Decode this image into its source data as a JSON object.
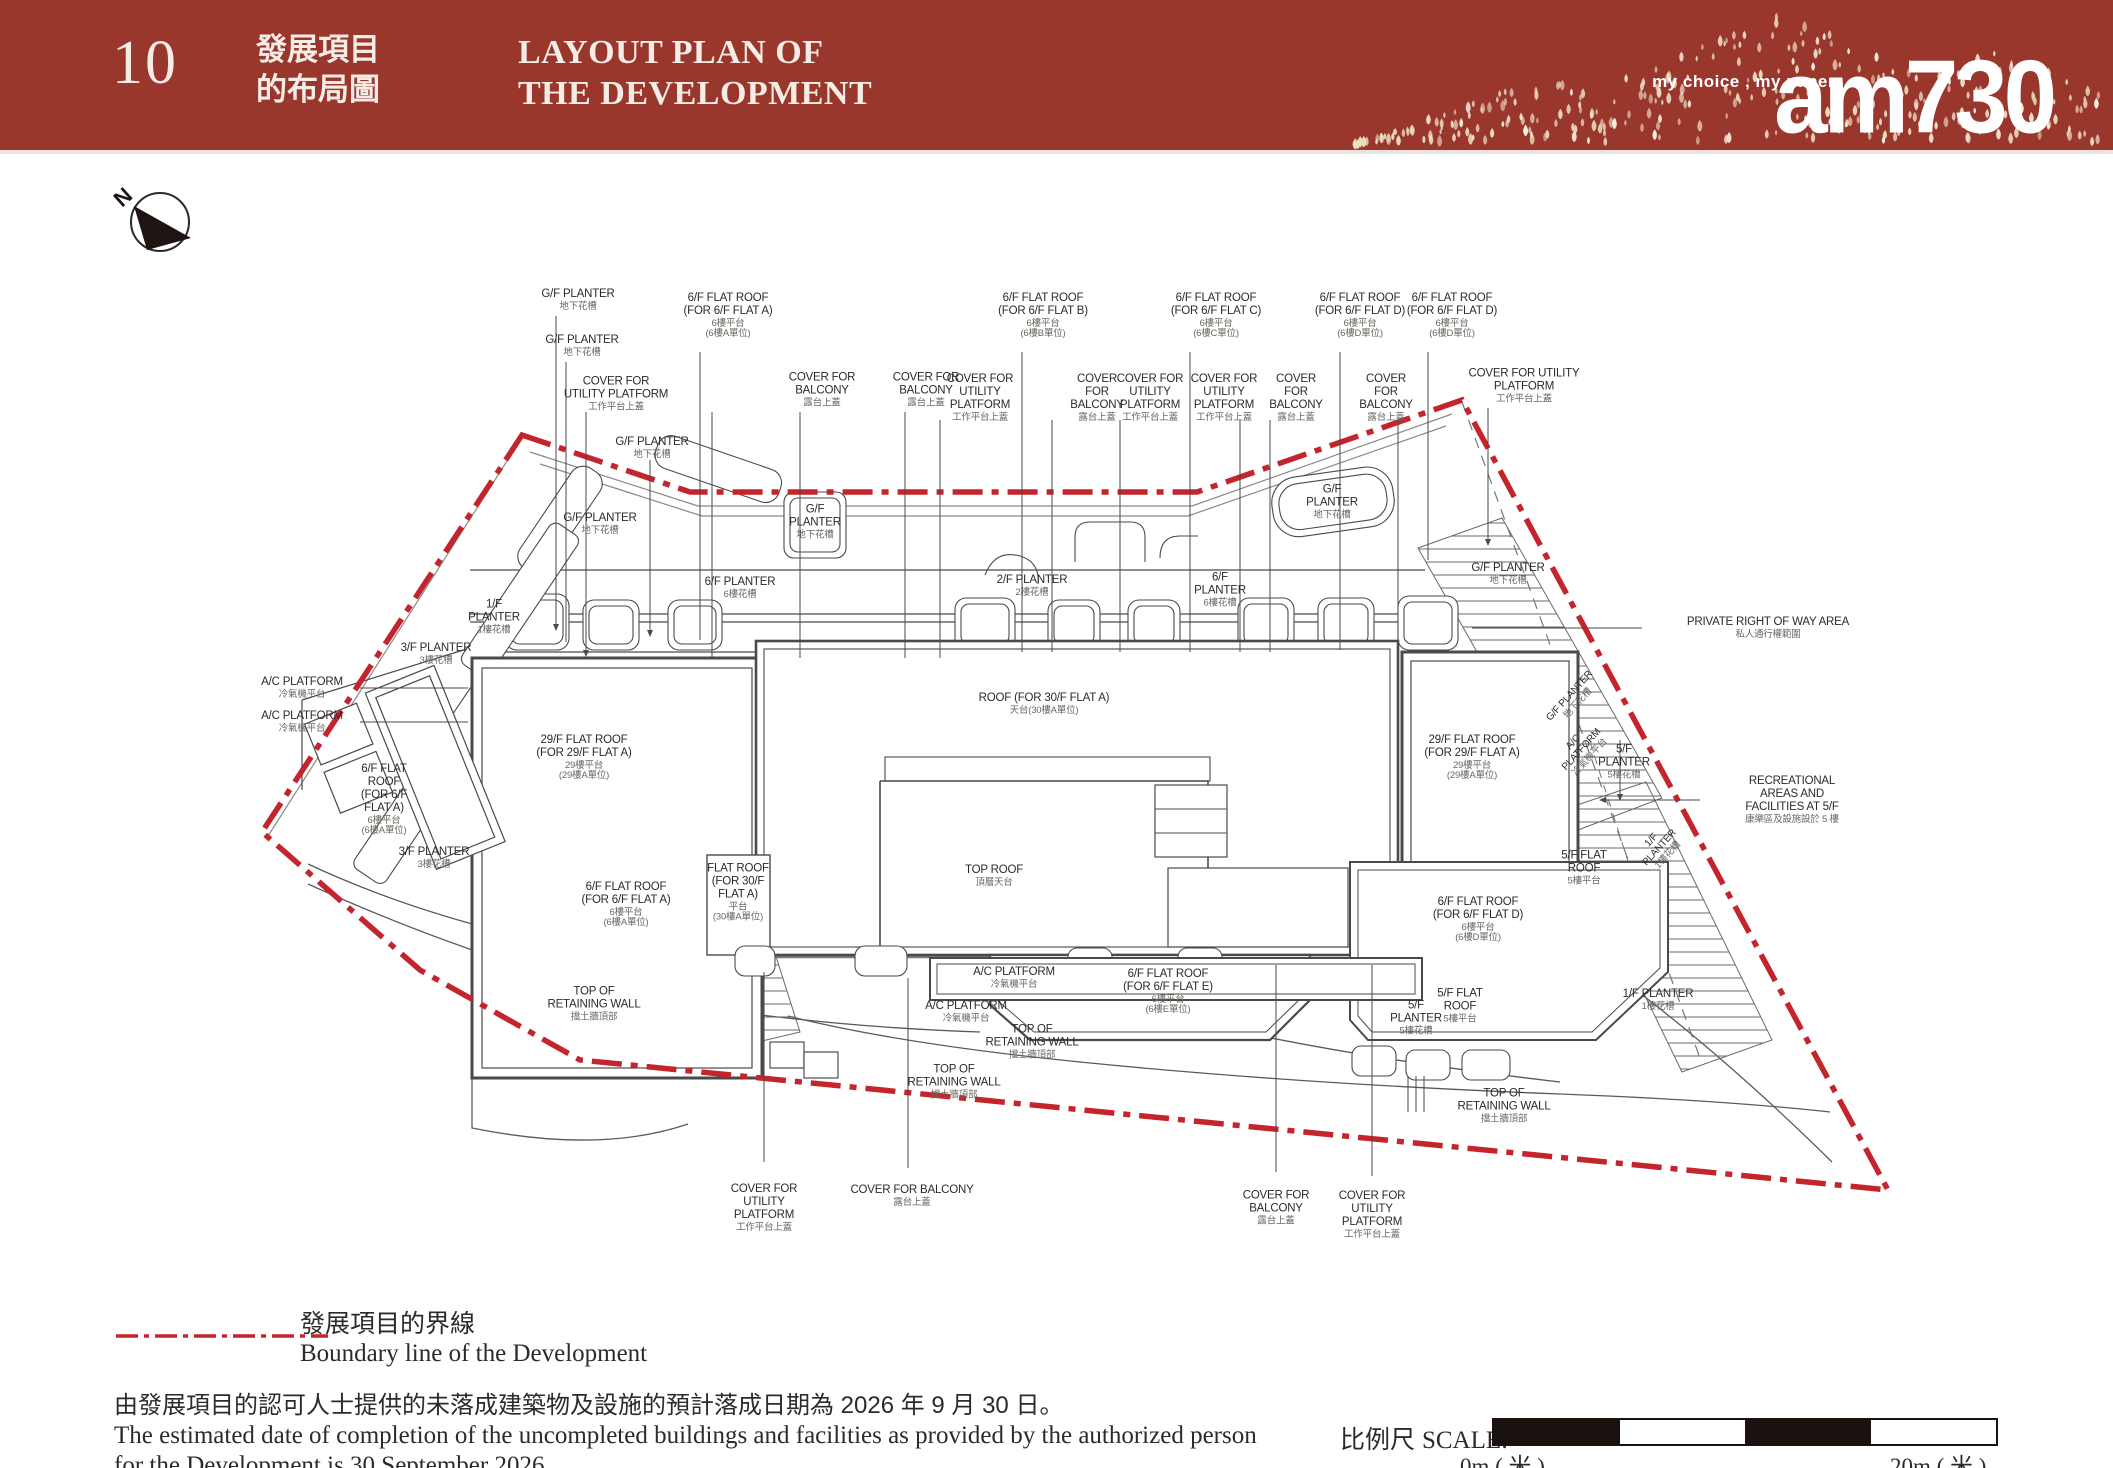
{
  "header": {
    "page_number": "10",
    "title_zh": "發展項目\n的布局圖",
    "title_en": "LAYOUT PLAN OF\nTHE DEVELOPMENT",
    "brand": {
      "tagline": "my choice , my paper",
      "logo": "am730"
    }
  },
  "colors": {
    "header_bg": "#9a372d",
    "boundary_red": "#c4242b",
    "line_grey": "#4a4a4a",
    "droplet_gold": "#ecdfc2"
  },
  "north_label": "N",
  "plan": {
    "labels": [
      {
        "en": "G/F PLANTER",
        "zh": "地下花槽",
        "x": 578,
        "y": 300
      },
      {
        "en": "G/F PLANTER",
        "zh": "地下花槽",
        "x": 582,
        "y": 346
      },
      {
        "en": "COVER FOR\nUTILITY PLATFORM",
        "zh": "工作平台上蓋",
        "x": 616,
        "y": 394
      },
      {
        "en": "6/F FLAT ROOF\n(FOR 6/F FLAT A)",
        "zh": "6樓平台\n(6樓A單位)",
        "x": 728,
        "y": 316
      },
      {
        "en": "COVER FOR\nBALCONY",
        "zh": "露台上蓋",
        "x": 822,
        "y": 390
      },
      {
        "en": "COVER FOR\nBALCONY",
        "zh": "露台上蓋",
        "x": 926,
        "y": 390
      },
      {
        "en": "COVER FOR\nUTILITY\nPLATFORM",
        "zh": "工作平台上蓋",
        "x": 980,
        "y": 398
      },
      {
        "en": "6/F FLAT ROOF\n(FOR 6/F FLAT B)",
        "zh": "6樓平台\n(6樓B單位)",
        "x": 1043,
        "y": 316
      },
      {
        "en": "COVER\nFOR\nBALCONY",
        "zh": "露台上蓋",
        "x": 1097,
        "y": 398
      },
      {
        "en": "COVER FOR\nUTILITY\nPLATFORM",
        "zh": "工作平台上蓋",
        "x": 1150,
        "y": 398
      },
      {
        "en": "6/F FLAT ROOF\n(FOR 6/F FLAT C)",
        "zh": "6樓平台\n(6樓C單位)",
        "x": 1216,
        "y": 316
      },
      {
        "en": "COVER FOR\nUTILITY\nPLATFORM",
        "zh": "工作平台上蓋",
        "x": 1224,
        "y": 398
      },
      {
        "en": "COVER\nFOR\nBALCONY",
        "zh": "露台上蓋",
        "x": 1296,
        "y": 398
      },
      {
        "en": "6/F FLAT ROOF\n(FOR 6/F FLAT D)",
        "zh": "6樓平台\n(6樓D單位)",
        "x": 1360,
        "y": 316
      },
      {
        "en": "COVER\nFOR\nBALCONY",
        "zh": "露台上蓋",
        "x": 1386,
        "y": 398
      },
      {
        "en": "6/F FLAT ROOF\n(FOR 6/F FLAT D)",
        "zh": "6樓平台\n(6樓D單位)",
        "x": 1452,
        "y": 316
      },
      {
        "en": "COVER FOR UTILITY\nPLATFORM",
        "zh": "工作平台上蓋",
        "x": 1524,
        "y": 386
      },
      {
        "en": "G/F PLANTER",
        "zh": "地下花槽",
        "x": 652,
        "y": 448
      },
      {
        "en": "G/F PLANTER",
        "zh": "地下花槽",
        "x": 600,
        "y": 524
      },
      {
        "en": "G/F\nPLANTER",
        "zh": "地下花槽",
        "x": 815,
        "y": 522
      },
      {
        "en": "G/F\nPLANTER",
        "zh": "地下花槽",
        "x": 1332,
        "y": 502
      },
      {
        "en": "G/F PLANTER",
        "zh": "地下花槽",
        "x": 1508,
        "y": 574
      },
      {
        "en": "6/F PLANTER",
        "zh": "6樓花槽",
        "x": 740,
        "y": 588
      },
      {
        "en": "2/F PLANTER",
        "zh": "2樓花槽",
        "x": 1032,
        "y": 586
      },
      {
        "en": "6/F\nPLANTER",
        "zh": "6樓花槽",
        "x": 1220,
        "y": 590
      },
      {
        "en": "1/F\nPLANTER",
        "zh": "1樓花槽",
        "x": 494,
        "y": 617
      },
      {
        "en": "3/F PLANTER",
        "zh": "3樓花槽",
        "x": 436,
        "y": 654
      },
      {
        "en": "PRIVATE RIGHT OF WAY AREA",
        "zh": "私人通行權範圍",
        "x": 1768,
        "y": 628
      },
      {
        "en": "A/C PLATFORM",
        "zh": "冷氣機平台",
        "x": 302,
        "y": 688
      },
      {
        "en": "A/C PLATFORM",
        "zh": "冷氣機平台",
        "x": 302,
        "y": 722
      },
      {
        "en": "ROOF (FOR 30/F FLAT A)",
        "zh": "天台(30樓A單位)",
        "x": 1044,
        "y": 704
      },
      {
        "en": "29/F FLAT ROOF\n(FOR 29/F FLAT A)",
        "zh": "29樓平台\n(29樓A單位)",
        "x": 584,
        "y": 758
      },
      {
        "en": "29/F FLAT ROOF\n(FOR 29/F FLAT A)",
        "zh": "29樓平台\n(29樓A單位)",
        "x": 1472,
        "y": 758
      },
      {
        "en": "G/F PLANTER",
        "zh": "地下花槽",
        "x": 1574,
        "y": 700,
        "rot": -48,
        "small": true
      },
      {
        "en": "A/C\nPLATFORM",
        "zh": "冷氣機平台",
        "x": 1582,
        "y": 750,
        "rot": -48,
        "small": true
      },
      {
        "en": "5/F\nPLANTER",
        "zh": "5樓花槽",
        "x": 1624,
        "y": 762
      },
      {
        "en": "RECREATIONAL\nAREAS AND\nFACILITIES AT 5/F",
        "zh": "康樂區及設施設於 5 樓",
        "x": 1792,
        "y": 800
      },
      {
        "en": "6/F FLAT\nROOF\n(FOR 6/F\nFLAT A)",
        "zh": "6樓平台\n(6樓A單位)",
        "x": 384,
        "y": 800
      },
      {
        "en": "1/F\nPLANTER",
        "zh": "1樓花槽",
        "x": 1660,
        "y": 848,
        "rot": -48,
        "small": true
      },
      {
        "en": "5/F FLAT\nROOF",
        "zh": "5樓平台",
        "x": 1584,
        "y": 868
      },
      {
        "en": "3/F PLANTER",
        "zh": "3樓花槽",
        "x": 434,
        "y": 858
      },
      {
        "en": "6/F FLAT ROOF\n(FOR 6/F FLAT A)",
        "zh": "6樓平台\n(6樓A單位)",
        "x": 626,
        "y": 905
      },
      {
        "en": "FLAT ROOF\n(FOR 30/F\nFLAT A)",
        "zh": "平台\n(30樓A單位)",
        "x": 738,
        "y": 893
      },
      {
        "en": "TOP ROOF",
        "zh": "頂層天台",
        "x": 994,
        "y": 876
      },
      {
        "en": "6/F FLAT ROOF\n(FOR 6/F FLAT D)",
        "zh": "6樓平台\n(6樓D單位)",
        "x": 1478,
        "y": 920
      },
      {
        "en": "TOP OF\nRETAINING WALL",
        "zh": "擋土牆頂部",
        "x": 594,
        "y": 1004
      },
      {
        "en": "A/C PLATFORM",
        "zh": "冷氣機平台",
        "x": 1014,
        "y": 978
      },
      {
        "en": "A/C PLATFORM",
        "zh": "冷氣機平台",
        "x": 966,
        "y": 1012
      },
      {
        "en": "6/F FLAT ROOF\n(FOR 6/F FLAT E)",
        "zh": "6樓平台\n(6樓E單位)",
        "x": 1168,
        "y": 992
      },
      {
        "en": "TOP OF\nRETAINING WALL",
        "zh": "擋土牆頂部",
        "x": 1032,
        "y": 1042
      },
      {
        "en": "5/F\nPLANTER",
        "zh": "5樓花槽",
        "x": 1416,
        "y": 1018
      },
      {
        "en": "5/F FLAT\nROOF",
        "zh": "5樓平台",
        "x": 1460,
        "y": 1006
      },
      {
        "en": "1/F PLANTER",
        "zh": "1樓花槽",
        "x": 1658,
        "y": 1000
      },
      {
        "en": "TOP OF\nRETAINING WALL",
        "zh": "擋土牆頂部",
        "x": 954,
        "y": 1082
      },
      {
        "en": "TOP OF\nRETAINING WALL",
        "zh": "擋土牆頂部",
        "x": 1504,
        "y": 1106
      },
      {
        "en": "COVER FOR\nUTILITY\nPLATFORM",
        "zh": "工作平台上蓋",
        "x": 764,
        "y": 1208
      },
      {
        "en": "COVER FOR BALCONY",
        "zh": "露台上蓋",
        "x": 912,
        "y": 1196
      },
      {
        "en": "COVER FOR\nBALCONY",
        "zh": "露台上蓋",
        "x": 1276,
        "y": 1208
      },
      {
        "en": "COVER FOR\nUTILITY\nPLATFORM",
        "zh": "工作平台上蓋",
        "x": 1372,
        "y": 1215
      }
    ]
  },
  "legend": {
    "zh": "發展項目的界線",
    "en": "Boundary line of the Development"
  },
  "completion_note": {
    "zh": "由發展項目的認可人士提供的未落成建築物及設施的預計落成日期為 2026 年 9 月 30 日。",
    "en_line1": "The estimated date of completion of the uncompleted buildings and facilities as provided by the authorized person",
    "en_line2": "for the Development is 30 September 2026."
  },
  "scale_bar": {
    "label_zh": "比例尺",
    "label_en": "SCALE:",
    "start": "0m ( 米 )",
    "end": "20m ( 米 )"
  }
}
